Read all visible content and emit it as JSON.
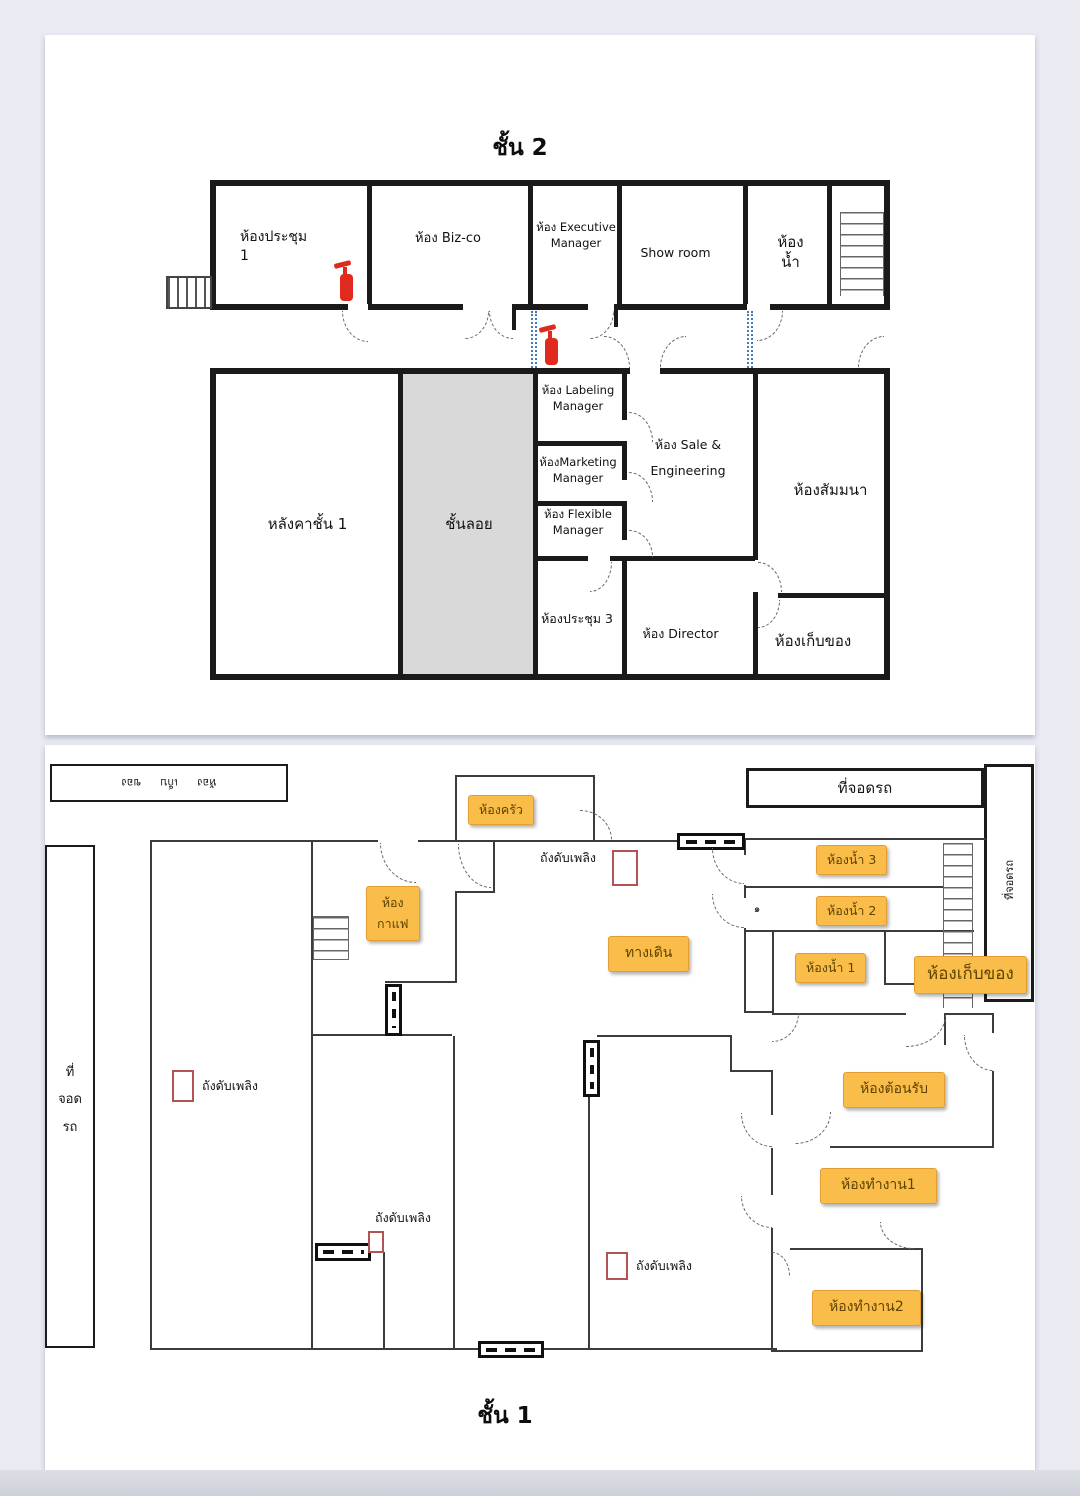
{
  "floor2": {
    "title": "ชั้น 2",
    "meeting1_line1": "ห้องประชุม",
    "meeting1_line2": "1",
    "bizco": "ห้อง Biz-co",
    "executive_line1": "ห้อง  Executive",
    "executive_line2": "Manager",
    "showroom": "Show room",
    "toilet_line1": "ห้อง",
    "toilet_line2": "น้ำ",
    "labeling_line1": "ห้อง  Labeling",
    "labeling_line2": "Manager",
    "sale_line1": "ห้อง  Sale &",
    "sale_line2": "Engineering",
    "seminar": "ห้องสัมมนา",
    "roof": "หลังคาชั้น  1",
    "mezzanine": "ชั้นลอย",
    "marketing_line1": "ห้องMarketing",
    "marketing_line2": "Manager",
    "flexible_line1": "ห้อง Flexible",
    "flexible_line2": "Manager",
    "meeting3": "ห้องประชุม 3",
    "director": "ห้อง  Director",
    "storage": "ห้องเก็บของ"
  },
  "floor1": {
    "title": "ชั้น 1",
    "storage_rotated": "ห้อง เก็บ ของ",
    "parking_top": "ที่จอดรถ",
    "parking_right_rotated": "ที่จอดรถ",
    "parking_left_line1": "ที่",
    "parking_left_line2": "จอด",
    "parking_left_line3": "รถ",
    "kitchen": "ห้องครัว",
    "toilet3": "ห้องน้ำ 3",
    "toilet2": "ห้องน้ำ 2",
    "toilet1": "ห้องน้ำ 1",
    "storage_badge": "ห้องเก็บของ",
    "coffee_line1": "ห้อง",
    "coffee_line2": "กาแฟ",
    "walkway": "ทางเดิน",
    "reception": "ห้องต้อนรับ",
    "office1": "ห้องทำงาน1",
    "office2": "ห้องทำงาน2",
    "fire_extinguisher": "ถังดับเพลิง",
    "door_mark": "๑"
  },
  "colors": {
    "badge_fill": "#FBBD4A",
    "badge_border": "#E29E35",
    "badge_text": "#5B4300",
    "wall_thick": "#1A1A1A",
    "wall_thin": "#3C3C3C",
    "extinguisher_red": "#DF2A1D",
    "extinguisher_outline": "#B25454",
    "connector_blue": "#4779B0",
    "mezzanine_gray": "#D9D9D9"
  }
}
